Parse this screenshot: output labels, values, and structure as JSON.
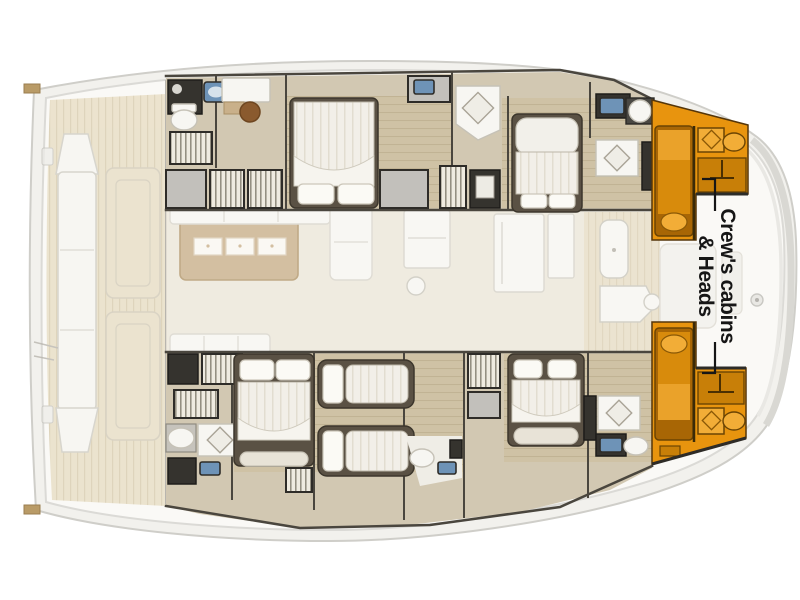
{
  "figure": {
    "type": "catamaran-deck-plan",
    "description": "Top-view yacht floor plan; crew's cabins and heads in the bows highlighted in orange, salon and aft deck shown faded"
  },
  "annotation": {
    "line1": "Crew's cabins",
    "line2": "& Heads"
  },
  "colors": {
    "highlight_orange": "#E8940E",
    "highlight_orange_dark": "#A86605",
    "highlight_orange_mid": "#D88B0C",
    "highlight_orange_light": "#F2AD37",
    "wall_dark": "#4A463E",
    "furniture_white": "#F7F6F2",
    "accent_blue": "#6E93B7",
    "teak": "#E7DCC1",
    "cabin_floor": "#D2C8B2",
    "island_tan": "#C9B08A",
    "hull_shell": "#F2F1ED",
    "label_text": "#161616"
  },
  "regions": {
    "highlighted": [
      "port-crew-cabin-and-head",
      "starboard-crew-cabin-and-head"
    ],
    "faded": [
      "aft-deck",
      "salon",
      "forward-cockpit"
    ]
  }
}
